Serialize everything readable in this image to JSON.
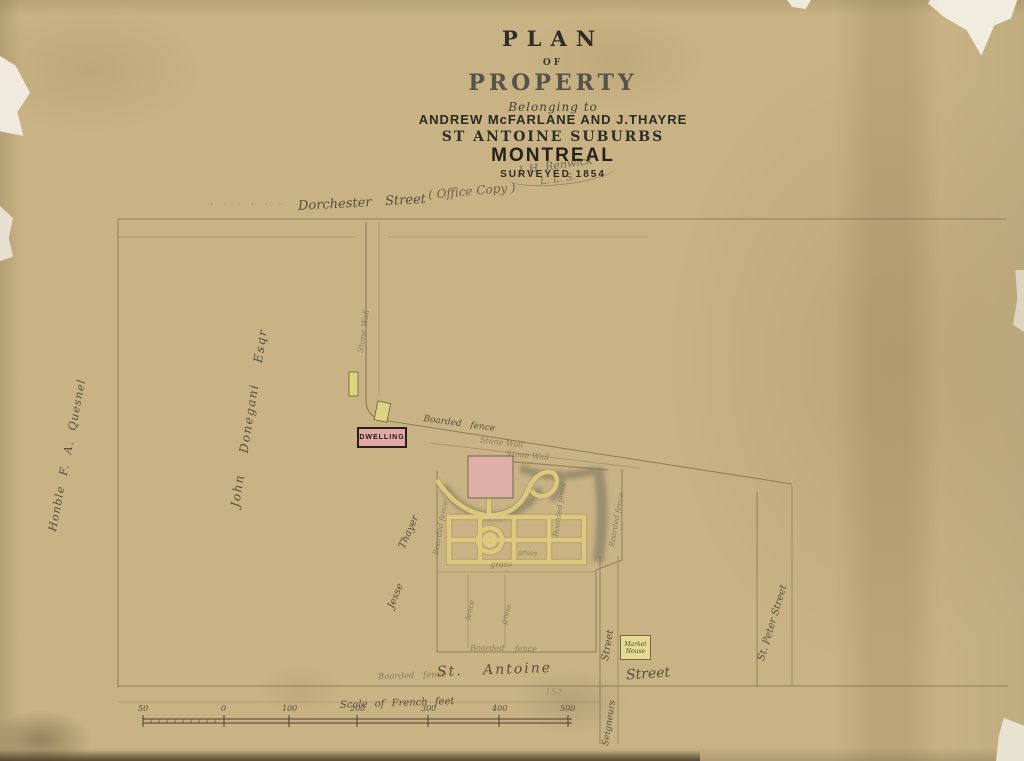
{
  "title_block": {
    "line1": "PLAN",
    "line2": "OF",
    "line3": "PROPERTY",
    "line4": "Belonging to",
    "line5": "ANDREW McFARLANE AND J.THAYRE",
    "line6": "ST ANTOINE SUBURBS",
    "line7": "MONTREAL",
    "line8": "SURVEYED 1854"
  },
  "annotations": {
    "office_copy": "( Office Copy )",
    "signature_name": "J. H. Renwick",
    "signature_title": "L. L. S.",
    "pencil_mark": "157",
    "survey_dots": "· · · · · ·"
  },
  "streets": {
    "dorchester_name": "Dorchester",
    "dorchester_type": "Street",
    "st_antoine_name": "St. Antoine",
    "st_antoine_type": "Street",
    "st_peter": "St. Peter Street",
    "seigneurs_name": "Seigneurs",
    "seigneurs_type": "Street"
  },
  "neighbors": {
    "west_far": "Honble F. A. Quesnel",
    "west": "John Donegani Esqr",
    "south_first": "Jesse",
    "south_last": "Thayer"
  },
  "labels": {
    "dwelling": "DWELLING",
    "stone_wall": "Stone Wall",
    "boarded_fence": "Boarded fence",
    "grass": "grass",
    "fence": "fence",
    "market_house_line1": "Market",
    "market_house_line2": "House"
  },
  "scale_bar": {
    "title": "Scale of French feet",
    "ticks": [
      "50",
      "0",
      "100",
      "200",
      "300",
      "400",
      "500"
    ]
  },
  "colors": {
    "paper": "#c9b384",
    "ink": "#34312a",
    "handwriting": "#564f3d",
    "building_pink": "#e2aca6",
    "outbuilding_yellow": "#ded47f",
    "path_yellow": "#e0cb82"
  }
}
